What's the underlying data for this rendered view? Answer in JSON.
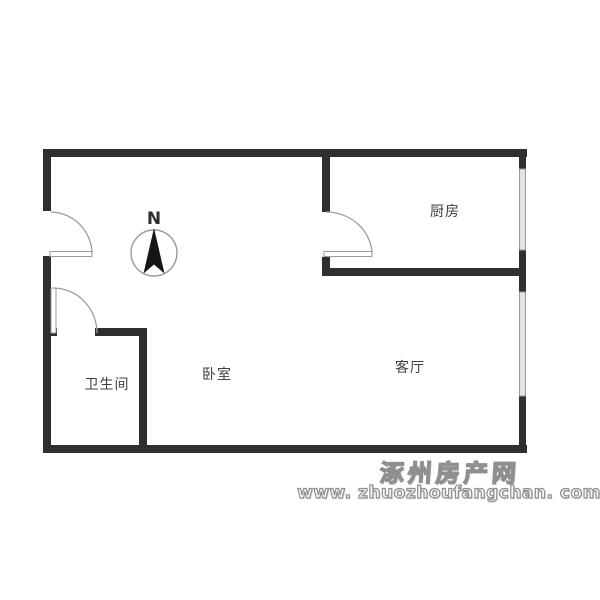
{
  "floorplan": {
    "rooms": {
      "kitchen": {
        "label": "厨房"
      },
      "living_room": {
        "label": "客厅"
      },
      "bedroom": {
        "label": "卧室"
      },
      "bathroom": {
        "label": "卫生间"
      }
    },
    "compass": {
      "label": "N"
    },
    "features": {
      "doors": [
        "entry-door",
        "kitchen-door",
        "bathroom-door"
      ],
      "windows": [
        "kitchen-window",
        "living-room-window"
      ]
    }
  },
  "watermark": {
    "site_name": "涿州房产网",
    "site_url": "www. zhuozhoufangchan. com"
  },
  "colors": {
    "wall": "#2f2f2f",
    "thin_line": "#9a9a9a",
    "window_fill": "#e3e3e3",
    "label_text": "#3f3f3f",
    "watermark_gray": "#8f8f8f",
    "background": "#ffffff"
  }
}
